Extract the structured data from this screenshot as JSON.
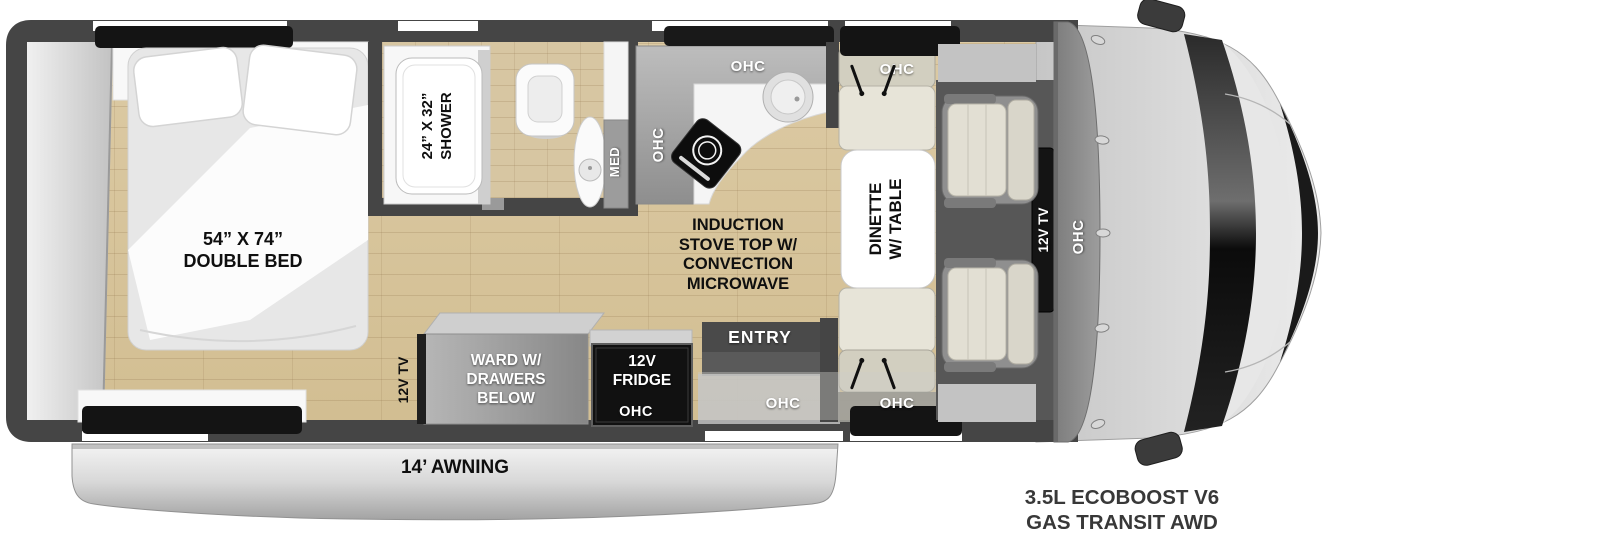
{
  "floorplan": {
    "bedroom": {
      "bed_size": "54” X 74”",
      "bed_type": "DOUBLE BED",
      "tv": "12V TV"
    },
    "bathroom": {
      "shower_size": "24” X 32”",
      "shower_name": "SHOWER",
      "med": "MED"
    },
    "kitchen": {
      "ohc_wall": "OHC",
      "ohc_top": "OHC",
      "stove": [
        "INDUCTION",
        "STOVE TOP W/",
        "CONVECTION",
        "MICROWAVE"
      ]
    },
    "dinette": {
      "name_line1": "DINETTE",
      "name_line2": "W/ TABLE",
      "ohc_top": "OHC",
      "ohc_bottom": "OHC"
    },
    "storage": {
      "ward_line1": "WARD W/",
      "ward_line2": "DRAWERS",
      "ward_line3": "BELOW",
      "fridge_line1": "12V",
      "fridge_line2": "FRIDGE",
      "fridge_ohc": "OHC"
    },
    "entry": {
      "label": "ENTRY",
      "ohc": "OHC"
    },
    "cab": {
      "tv": "12V TV",
      "ohc": "OHC"
    },
    "exterior": {
      "awning": "14’ AWNING"
    },
    "chassis": {
      "line1": "3.5L ECOBOOST V6",
      "line2": "GAS TRANSIT AWD"
    },
    "colors": {
      "wall": "#454545",
      "floor": "#d8c59c",
      "cab_body": "#d6d6d6",
      "windshield": "#111111"
    }
  }
}
